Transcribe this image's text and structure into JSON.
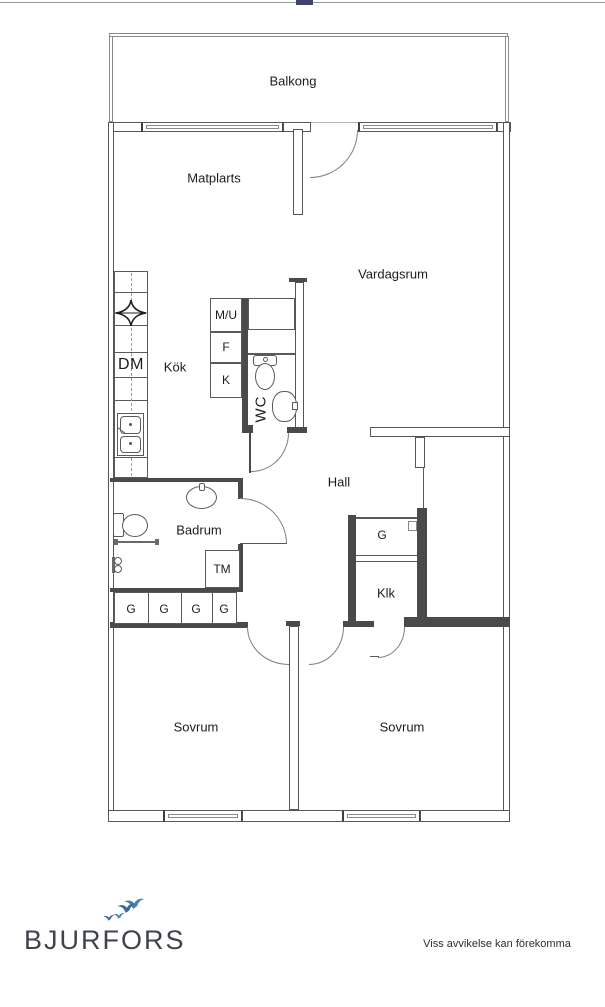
{
  "browser": {
    "scrollbar_track_color": "#a8a8a8",
    "scrollbar_thumb_color": "#3e4266"
  },
  "floorplan": {
    "rooms": {
      "balkong": "Balkong",
      "matplats": "Matplarts",
      "vardagsrum": "Vardagsrum",
      "kok": "Kök",
      "wc": "WC",
      "hall": "Hall",
      "badrum": "Badrum",
      "klk": "Klk",
      "sovrum_left": "Sovrum",
      "sovrum_right": "Sovrum"
    },
    "units": {
      "micro_oven": "M/U",
      "freezer": "F",
      "fridge": "K",
      "dishwasher": "DM",
      "washing_machine": "TM",
      "wardrobe": "G"
    },
    "icons": [
      "stove-star-icon",
      "kitchen-sink-icon",
      "toilet-icon",
      "washbasin-icon",
      "grab-bar",
      "shower-tap-icon",
      "door-arc",
      "window"
    ],
    "colors": {
      "wall": "#4a4a4a",
      "line": "#5a5a5a",
      "door_arc": "#7e7e7e"
    }
  },
  "footer": {
    "brand": "BJURFORS",
    "disclaimer": "Viss avvikelse kan förekomma",
    "logo_colors": {
      "bird_main": "#4e81ac",
      "bird_dark": "#3a6a96"
    }
  }
}
